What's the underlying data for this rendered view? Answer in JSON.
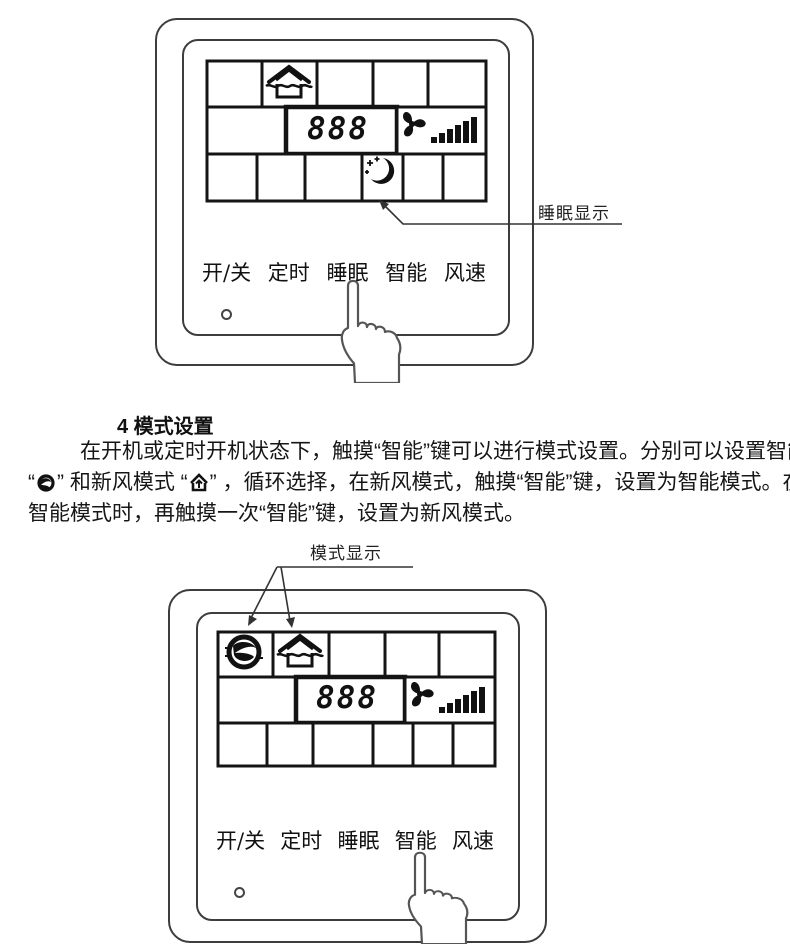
{
  "figure_top": {
    "annotation_label": "睡眠显示",
    "display_value": "888"
  },
  "figure_bottom": {
    "annotation_label": "模式显示",
    "display_value": "888"
  },
  "panel_buttons": [
    "开/关",
    "定时",
    "睡眠",
    "智能",
    "风速"
  ],
  "icons": {
    "fresh_air_mode": "house-arrow-icon",
    "smart_mode": "globe-swirl-icon",
    "fan": "fan-icon",
    "fan_speed_bars": "speed-ramp-icon",
    "sleep": "crescent-moon-icon",
    "power_led": "led-dot-icon",
    "touch_hand": "pointing-hand-icon"
  },
  "section": {
    "heading": "4 模式设置",
    "line1": "在开机或定时开机状态下，触摸“智能”键可以进行模式设置。分别可以设置智能模式",
    "line2_pre": "“",
    "line2_mid": "” 和新风模式 “",
    "line2_post": "” ，循环选择，在新风模式，触摸“智能”键，设置为智能模式。在",
    "line3": "智能模式时，再触摸一次“智能”键，设置为新风模式。"
  }
}
